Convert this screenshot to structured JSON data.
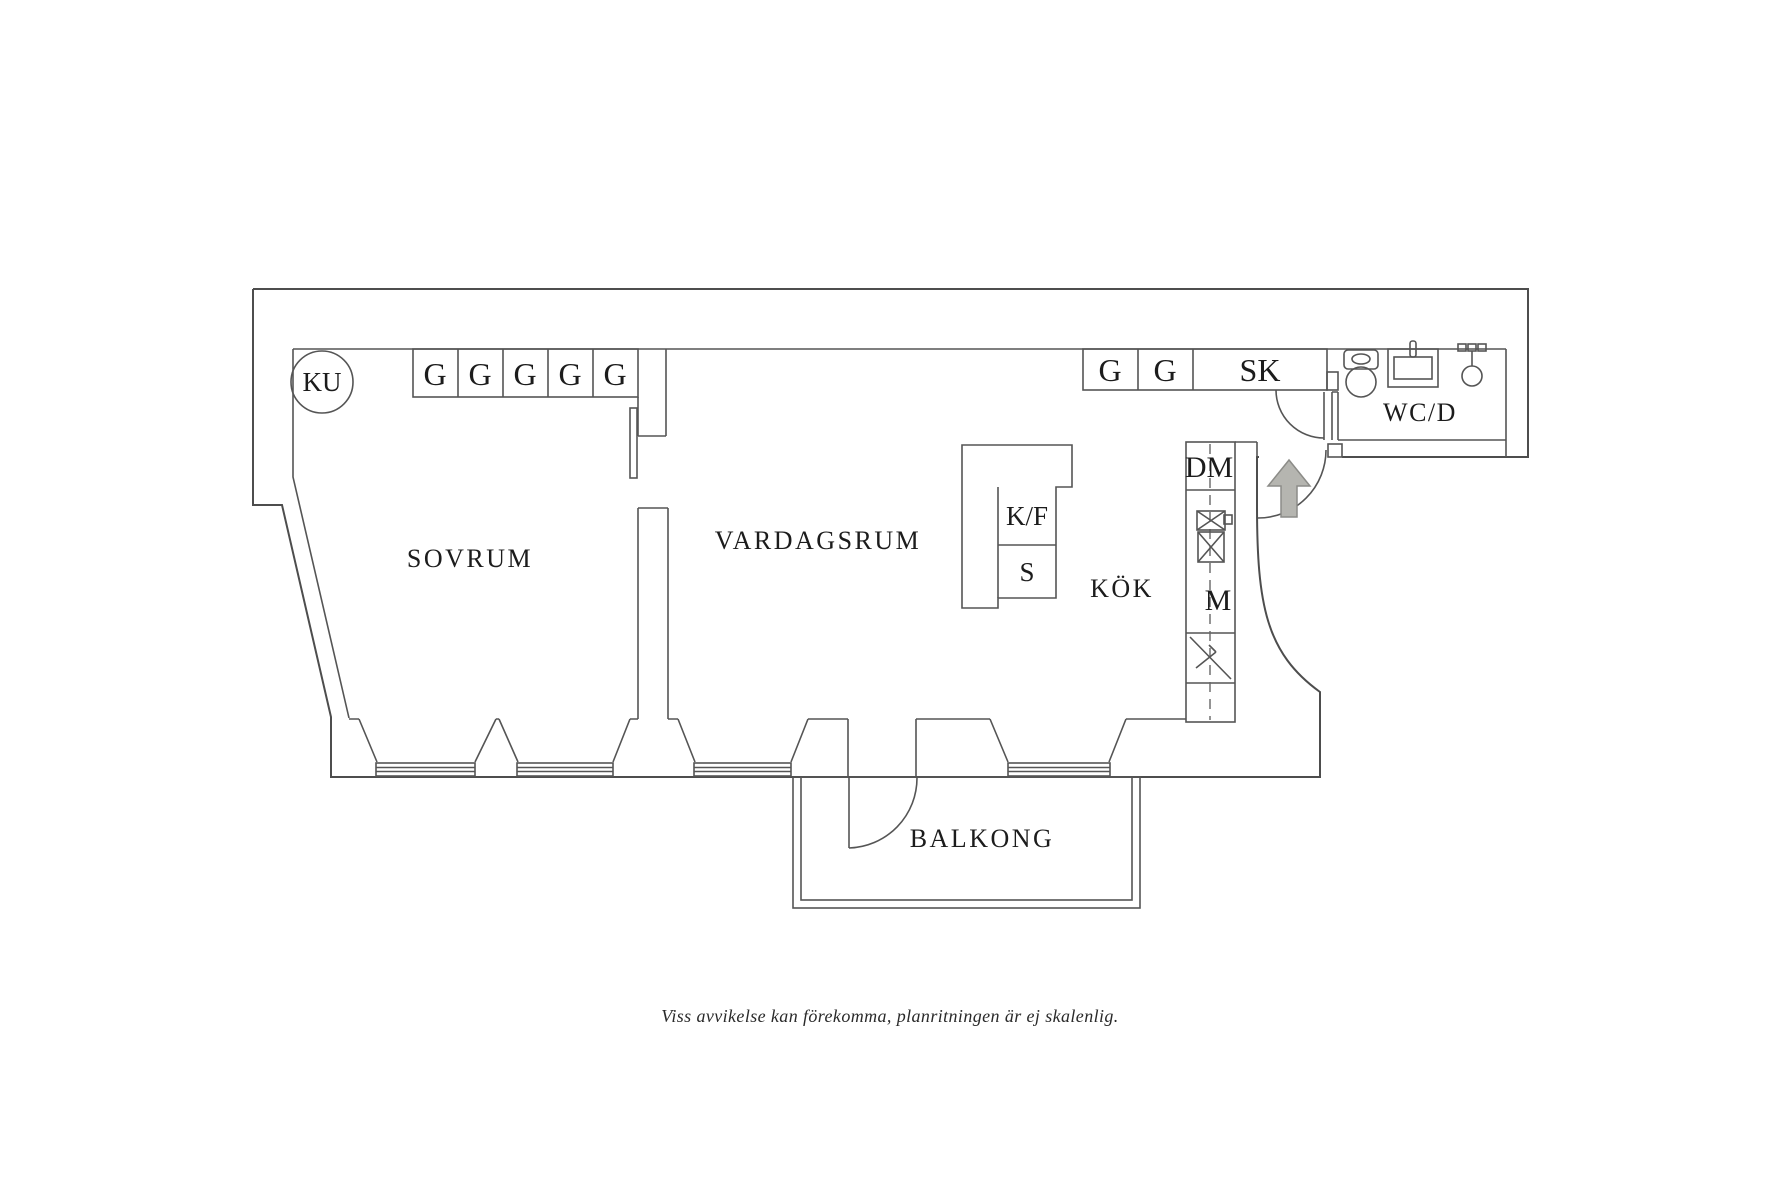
{
  "plan": {
    "rooms": {
      "bedroom": "SOVRUM",
      "living_room": "VARDAGSRUM",
      "kitchen": "KÖK",
      "bathroom": "WC/D",
      "balcony": "BALKONG"
    },
    "bedroom_wardrobes": [
      "G",
      "G",
      "G",
      "G",
      "G"
    ],
    "hall_cabinets": [
      "G",
      "G",
      "SK"
    ],
    "fixtures": {
      "cold_cupboard": "KU",
      "dishwasher": "DM",
      "microwave": "M",
      "fridge_freezer": "K/F",
      "stove": "S"
    },
    "disclaimer": "Viss avvikelse kan förekomma, planritningen är ej skalenlig.",
    "colors": {
      "wall_line": "#4d4d4d",
      "text": "#1c1c1c",
      "arrow_fill": "#b5b5b0",
      "arrow_stroke": "#8c8c88"
    }
  }
}
